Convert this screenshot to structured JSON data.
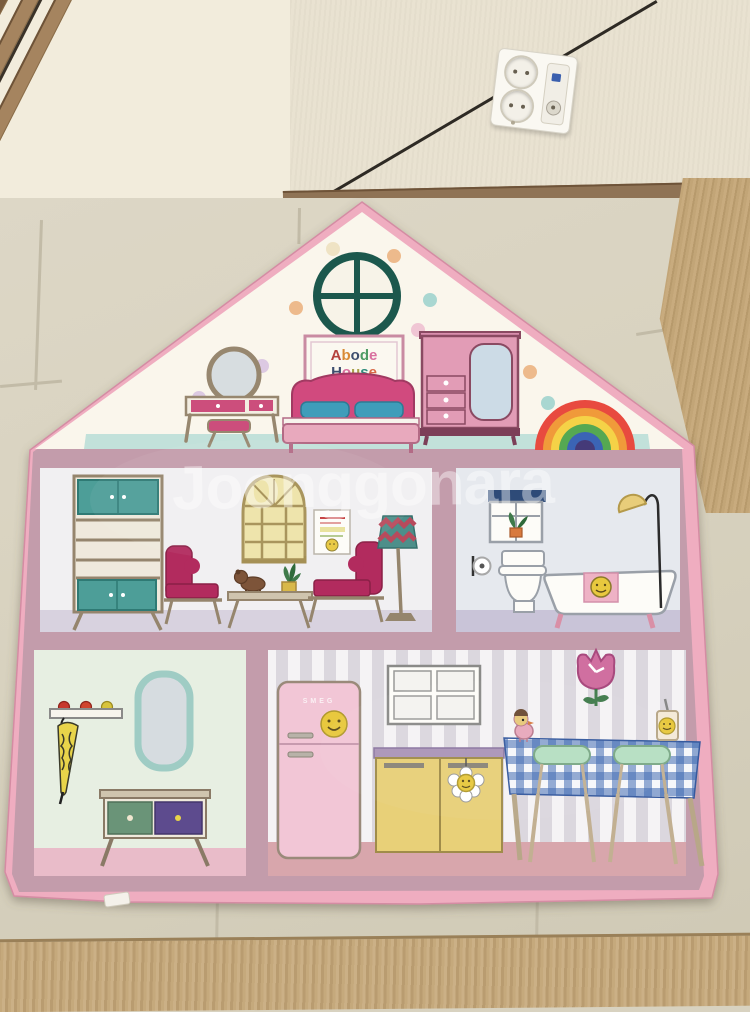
{
  "photo": {
    "watermark_text": "Joonggonara",
    "rug": {
      "sign_line1": "Abode",
      "sign_line2": "House",
      "sign_colors_line1": [
        "#b5413c",
        "#d98a35",
        "#3e4e6e",
        "#4e9c63",
        "#d9709f"
      ],
      "sign_colors_line2": [
        "#3e4e6e",
        "#d9709f",
        "#a8a048",
        "#2f8c7c",
        "#d96a48"
      ],
      "fridge_logo_text": "SMEG"
    },
    "colors": {
      "rug_binding": "#efadc0",
      "rug_frame": "#c39cab",
      "attic_bg": "#faf6ec",
      "attic_floor": "#c2e1da",
      "living_wall": "#f1f0f2",
      "living_floor": "#d8d2df",
      "bath_wall": "#e6e9ee",
      "bath_floor": "#c9c4d8",
      "hall_wall": "#e7efe2",
      "hall_floor": "#e9bcc9",
      "kitchen_floor": "#d8a6ac"
    }
  }
}
